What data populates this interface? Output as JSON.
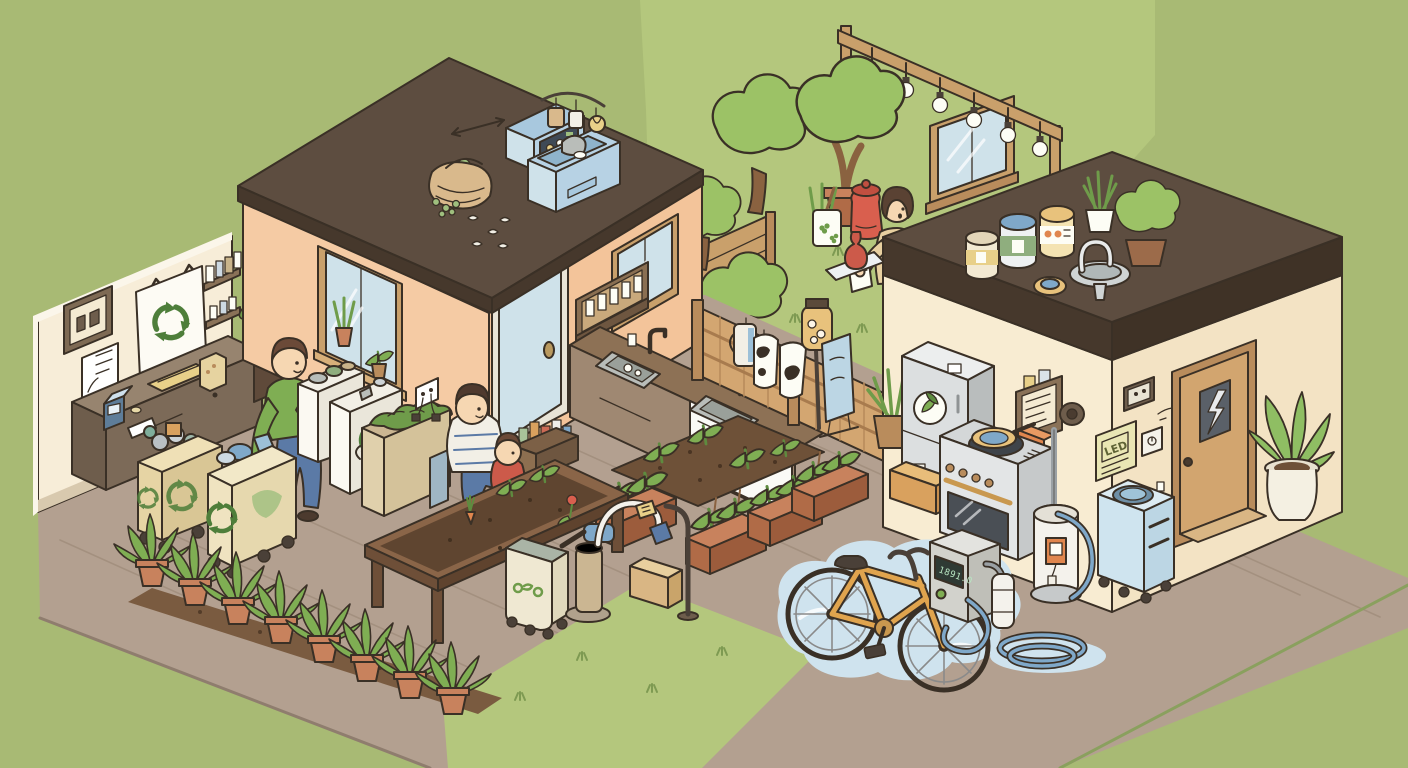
{
  "scene": {
    "title": "Eco-friendly home illustration",
    "style": "isometric cartoon cutaway of two houses, recycling corner, vegetable garden, courtyard and bike-washing corner",
    "background_color": "#a8ba74"
  },
  "palette": {
    "background": "#a8ba74",
    "lawn": "#b4c77d",
    "deck_wood": "#b3a090",
    "soil": "#6e5138",
    "roof_dark": "#5d4d40",
    "wall_peach": "#f5cba4",
    "wall_cream": "#f8ecd2",
    "fence_wood": "#d3a671",
    "foliage": "#9cc266",
    "terracotta": "#c8825d",
    "appliance_blue": "#cfe2ea",
    "water_blue": "#cfe3ee",
    "accent_red": "#d95f4e",
    "recycle_green": "#4e7e3a",
    "bike_orange": "#e0a44e",
    "outline": "#3a3026"
  },
  "texts": {
    "led_sign": "LED",
    "charger_display": "1891.0"
  },
  "icons": [
    "recycle-icon",
    "leaf-logo-icon",
    "lightning-icon",
    "clover-icon"
  ],
  "people": [
    {
      "id": "man-sorting",
      "desc": "man in green shirt sorting recyclables into carts"
    },
    {
      "id": "adult-with-child",
      "desc": "adult in striped shirt sitting on deck edge"
    },
    {
      "id": "child",
      "desc": "child in red shirt sitting beside adult"
    },
    {
      "id": "woman-gardening",
      "desc": "woman in beige top tending courtyard garden"
    }
  ],
  "areas": {
    "recycling_room": {
      "name": "community recycling corner",
      "items": [
        "recycling banner with recycle symbol",
        "pictogram frame",
        "checklist frame",
        "wall shelves with jars",
        "service counter",
        "card reader device",
        "paper card",
        "folded yellow cloth",
        "detergent carton",
        "recycling cart full of cans",
        "recycling cart full of bottles",
        "potted ficus plant",
        "white sorting bins with recycle mark",
        "food scrap bin full of greens",
        "small blue bin",
        "wall outlet with plugs"
      ]
    },
    "left_house": {
      "name": "eco house with pitched roof",
      "items": [
        "dark pitched roof",
        "rooftop compost basket",
        "rooftop food-waste dryer",
        "hanging dried produce",
        "scattered fruit peels",
        "weather arrow",
        "gable window with windowsill plants",
        "blue front door",
        "side window",
        "wall bottle drying rack",
        "kitchen counter with two sinks",
        "dishwasher front",
        "crate of bottles"
      ]
    },
    "courtyard": {
      "name": "garden courtyard",
      "items": [
        "leafy trees",
        "potted tree",
        "wooden fences",
        "string lights on wooden beam",
        "garden window",
        "red compost bin",
        "white pot with clover pattern",
        "red vase on tray",
        "watering jug on fence",
        "cow-print bags on fence",
        "jar feeder on pole",
        "blue message board"
      ]
    },
    "deck_garden": {
      "name": "deck vegetable garden",
      "items": [
        "soil patch with sprouts",
        "terracotta planter boxes with staked seedlings",
        "row of potted plants on soil strip",
        "wooden planting table with seedlings",
        "rolling compost bin",
        "hand water pump",
        "hose stand with tagged nozzle",
        "cardboard box"
      ]
    },
    "right_house": {
      "name": "eco house with flat roof",
      "items": [
        "flat roof with paint cans",
        "rooftop potted plants",
        "rooftop rainwater faucet and basin",
        "refrigerator with leaf logo",
        "induction stove with pan",
        "oven",
        "wall control panel with jars",
        "orange dispenser box",
        "round wall meter",
        "water purifier cylinder with tag",
        "coiled garden hose",
        "LED sign",
        "small wall frame",
        "light switch",
        "wooden door with lightning window",
        "door step",
        "blue wash cart with basin",
        "potted plant by door",
        "open box with jar"
      ]
    },
    "ev_corner": {
      "name": "washing and charging corner",
      "items": [
        "large water puddle",
        "orange bicycle lying in puddle",
        "charging station with digital display",
        "green indicator light",
        "white sprayer canister",
        "blue hoses"
      ]
    }
  }
}
